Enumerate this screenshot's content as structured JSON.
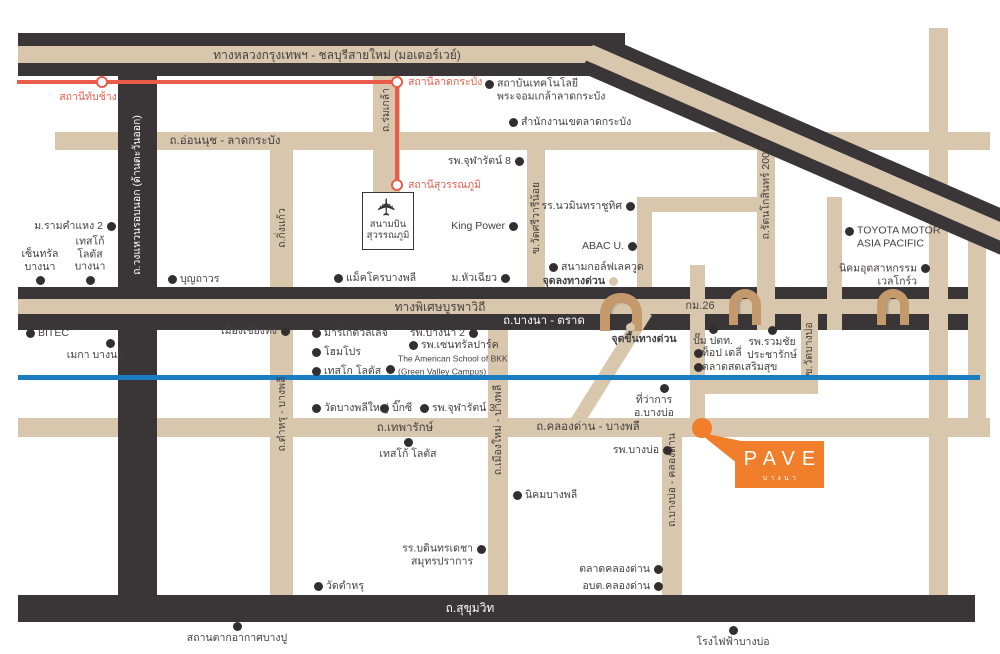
{
  "map": {
    "colors": {
      "tan": "#d9c7ad",
      "dark": "#3a3637",
      "text": "#454041",
      "red": "#e85c49",
      "blue": "#1a7dc1",
      "orange": "#f07e2a",
      "arch": "#c49a6c",
      "dot": "#332f30"
    },
    "tan_roads": [
      {
        "x": 55,
        "y": 132,
        "w": 935,
        "h": 18,
        "n": "onnut-ladkrabang-road"
      },
      {
        "x": 18,
        "y": 418,
        "w": 972,
        "h": 19,
        "n": "thepharak-klongdan-road"
      },
      {
        "x": 270,
        "y": 132,
        "w": 23,
        "h": 463,
        "n": "kingkaew-tamru-road"
      },
      {
        "x": 373,
        "y": 64,
        "w": 27,
        "h": 131,
        "n": "romklao-road"
      },
      {
        "x": 488,
        "y": 330,
        "w": 20,
        "h": 265,
        "n": "muangmai-bangphli-road"
      },
      {
        "x": 527,
        "y": 140,
        "w": 18,
        "h": 177,
        "n": "srivareenoi-road"
      },
      {
        "x": 662,
        "y": 420,
        "w": 20,
        "h": 175,
        "n": "bangbo-klongdan-road"
      },
      {
        "x": 637,
        "y": 197,
        "w": 138,
        "h": 15,
        "n": "link-road-horizontal"
      },
      {
        "x": 637,
        "y": 197,
        "w": 15,
        "h": 103,
        "n": "link-road-vertical"
      }
    ],
    "dark_roads": [
      {
        "x": 118,
        "y": 33,
        "w": 39,
        "h": 589,
        "n": "outer-ring-road"
      },
      {
        "x": 18,
        "y": 33,
        "w": 607,
        "h": 13,
        "n": "motorway-edge-top"
      },
      {
        "x": 18,
        "y": 46,
        "w": 607,
        "h": 17,
        "c": "#d9c7ad",
        "n": "motorway-center"
      },
      {
        "x": 18,
        "y": 63,
        "w": 607,
        "h": 13,
        "n": "motorway-edge-bottom"
      },
      {
        "x": 18,
        "y": 595,
        "w": 957,
        "h": 27,
        "n": "sukhumvit-road"
      }
    ],
    "band_roads": [
      {
        "x": 18,
        "y": 287,
        "w": 967,
        "h": 12,
        "c": "#3a3637",
        "n": "burapha-expressway-edge-top"
      },
      {
        "x": 18,
        "y": 299,
        "w": 967,
        "h": 15,
        "c": "#d9c7ad",
        "n": "burapha-expressway-center"
      },
      {
        "x": 18,
        "y": 314,
        "w": 967,
        "h": 16,
        "c": "#3a3637",
        "n": "bangna-trad-road"
      }
    ],
    "tan_roads_over": [
      {
        "x": 690,
        "y": 265,
        "w": 15,
        "h": 163,
        "n": "minor-road-a"
      },
      {
        "x": 757,
        "y": 132,
        "w": 18,
        "h": 198,
        "n": "rattanakosin-200pi-road"
      },
      {
        "x": 827,
        "y": 197,
        "w": 15,
        "h": 133,
        "n": "minor-road-b"
      },
      {
        "x": 801,
        "y": 300,
        "w": 17,
        "h": 94,
        "n": "watbangbo-road"
      },
      {
        "x": 700,
        "y": 380,
        "w": 118,
        "h": 14,
        "n": "watbangbo-road-elbow"
      },
      {
        "x": 929,
        "y": 28,
        "w": 19,
        "h": 567,
        "n": "right-vertical-road-1"
      },
      {
        "x": 968,
        "y": 222,
        "w": 18,
        "h": 206,
        "n": "right-vertical-road-2"
      }
    ],
    "diagonals": [
      {
        "kind": "band",
        "x": 598,
        "y": 33,
        "w": 472,
        "h": 43,
        "rot": 23.5,
        "stripes": [
          [
            "#3a3637",
            13
          ],
          [
            "#d9c7ad",
            17
          ],
          [
            "#3a3637",
            13
          ]
        ],
        "n": "motorway-diagonal"
      },
      {
        "kind": "plain",
        "x": 640,
        "y": 308,
        "w": 14,
        "h": 130,
        "rot": 32,
        "c": "#d9c7ad",
        "n": "expressway-ramp"
      }
    ],
    "blue_line": {
      "x": 18,
      "y": 375,
      "w": 962,
      "h": 5,
      "n": "blue-canal-line"
    },
    "arches": [
      {
        "x": 600,
        "y": 293,
        "w": 42,
        "h": 38,
        "b": 10
      },
      {
        "x": 729,
        "y": 289,
        "w": 32,
        "h": 36,
        "b": 9
      },
      {
        "x": 877,
        "y": 289,
        "w": 32,
        "h": 36,
        "b": 9
      }
    ],
    "rail": {
      "segments": [
        {
          "x": 17,
          "y": 80,
          "w": 382,
          "h": 4
        },
        {
          "x": 395,
          "y": 80,
          "w": 4,
          "h": 107
        }
      ],
      "stations": [
        {
          "cx": 102,
          "cy": 82,
          "label": "สถานีทับช้าง",
          "side": "below",
          "lx": 88,
          "ly": 97
        },
        {
          "cx": 397,
          "cy": 82,
          "label": "สถานีลาดกระบัง",
          "side": "right",
          "lx": 408,
          "ly": 82
        },
        {
          "cx": 397,
          "cy": 185,
          "label": "สถานีสุวรรณภูมิ",
          "side": "right",
          "lx": 408,
          "ly": 185
        }
      ]
    },
    "road_labels": [
      {
        "t": "ทางหลวงกรุงเทพฯ - ชลบุรีสายใหม่ (มอเตอร์เวย์)",
        "x": 337,
        "y": 55,
        "fs": 12
      },
      {
        "t": "ถ.อ่อนนุช - ลาดกระบัง",
        "x": 225,
        "y": 141,
        "fs": 11.5
      },
      {
        "t": "ทางพิเศษบูรพาวิถี",
        "x": 440,
        "y": 307,
        "fs": 12
      },
      {
        "t": "กม.26",
        "x": 700,
        "y": 306,
        "fs": 11
      },
      {
        "t": "ถ.บางนา - ตราด",
        "x": 544,
        "y": 321,
        "fs": 11.5,
        "c": "#ffffff"
      },
      {
        "t": "ถ.เทพารักษ์",
        "x": 405,
        "y": 428,
        "fs": 11.5
      },
      {
        "t": "ถ.คลองด่าน - บางพลี",
        "x": 588,
        "y": 427,
        "fs": 11.5
      },
      {
        "t": "ถ.สุขุมวิท",
        "x": 470,
        "y": 608,
        "fs": 12,
        "c": "#ffffff"
      },
      {
        "t": "ถ.วงแหวนรอบนอก (ด้านตะวันออก)",
        "x": 137,
        "y": 195,
        "rot": -90,
        "fs": 10.5,
        "c": "#ffffff"
      },
      {
        "t": "ถ.ร่มเกล้า",
        "x": 386,
        "y": 110,
        "rot": -90,
        "fs": 10.5
      },
      {
        "t": "ถ.กิ่งแก้ว",
        "x": 282,
        "y": 228,
        "rot": -90,
        "fs": 10.5
      },
      {
        "t": "ข.วัดศรีวารีน้อย",
        "x": 536,
        "y": 218,
        "rot": -90,
        "fs": 10.5
      },
      {
        "t": "ถ.รัตนโกสินทร์ 200 ปี",
        "x": 766,
        "y": 191,
        "rot": -90,
        "fs": 10.5
      },
      {
        "t": "ข.วัดบางบ่อ",
        "x": 809,
        "y": 349,
        "rot": -90,
        "fs": 10.5
      },
      {
        "t": "ถ.ตำหรุ - บางพลี",
        "x": 282,
        "y": 414,
        "rot": -90,
        "fs": 10.5
      },
      {
        "t": "ถ.เมืองใหม่ - บางพลี",
        "x": 498,
        "y": 430,
        "rot": -90,
        "fs": 10.5
      },
      {
        "t": "ถ.บางบ่อ - คลองด่าน",
        "x": 672,
        "y": 480,
        "rot": -90,
        "fs": 10.5
      }
    ],
    "pois": [
      {
        "d": [
          489,
          84
        ],
        "t": "สถาบันเทคโนโลยี\nพระจอมเกล้าลาดกระบัง",
        "side": "right",
        "dy": 6
      },
      {
        "d": [
          513,
          122
        ],
        "t": "สำนักงานเขตลาดกระบัง",
        "side": "right"
      },
      {
        "d": [
          519,
          161
        ],
        "t": "รพ.จุฬารัตน์ 8",
        "side": "left"
      },
      {
        "d": [
          513,
          226
        ],
        "t": "King Power",
        "side": "left"
      },
      {
        "d": [
          630,
          206
        ],
        "t": "รร.นวมินทราชูทิศ",
        "side": "left"
      },
      {
        "d": [
          632,
          246
        ],
        "t": "ABAC U.",
        "side": "left"
      },
      {
        "d": [
          553,
          267
        ],
        "t": "สนามกอล์ฟเลควูด",
        "side": "right"
      },
      {
        "d": [
          613,
          281
        ],
        "t": "จุดลงทางด่วน",
        "side": "left",
        "b": true,
        "tan": true
      },
      {
        "d": [
          338,
          278
        ],
        "t": "แม็คโครบางพลี",
        "side": "right"
      },
      {
        "d": [
          505,
          278
        ],
        "t": "ม.หัวเฉียว",
        "side": "left"
      },
      {
        "d": [
          849,
          231
        ],
        "t": "TOYOTA MOTOR\nASIA PACIFIC",
        "side": "right",
        "dy": 6
      },
      {
        "d": [
          925,
          268
        ],
        "t": "นิคมอุตสาหกรรม\nเวลโกร์ว",
        "side": "left",
        "dy": 7
      },
      {
        "d": [
          111,
          226
        ],
        "t": "ม.รามคำแหง 2",
        "side": "left"
      },
      {
        "d": [
          40,
          280
        ],
        "t": "เซ็นทรัล\nบางนา",
        "side": "above"
      },
      {
        "d": [
          90,
          280
        ],
        "t": "เทสโก้\nโลตัส\nบางนา",
        "side": "above"
      },
      {
        "d": [
          172,
          279
        ],
        "t": "บุญถาวร",
        "side": "right"
      },
      {
        "d": [
          30,
          333
        ],
        "t": "BITEC",
        "side": "right"
      },
      {
        "d": [
          110,
          343
        ],
        "t": "เมกา บางนา",
        "side": "below",
        "dx": -15
      },
      {
        "d": [
          285,
          331
        ],
        "t": "เมืองเชียงทง",
        "side": "left"
      },
      {
        "d": [
          316,
          333
        ],
        "t": "มาร์เกตวิลเลจ",
        "side": "right"
      },
      {
        "d": [
          316,
          352
        ],
        "t": "โฮมโปร",
        "side": "right"
      },
      {
        "d": [
          316,
          371
        ],
        "t": "เทสโก โลตัส",
        "side": "right"
      },
      {
        "d": [
          473,
          333
        ],
        "t": "รพ.บางนา 2",
        "side": "left"
      },
      {
        "d": [
          413,
          345
        ],
        "t": "รพ.เซนทรัลปาร์ค",
        "side": "right"
      },
      {
        "d": [
          390,
          369
        ],
        "t": "The American School of BKK\n(Green Valley Campus)",
        "side": "right",
        "fs": 8.5,
        "dy": -4
      },
      {
        "d": [
          316,
          408
        ],
        "t": "วัดบางพลีใหญ่",
        "side": "right"
      },
      {
        "d": [
          384,
          408
        ],
        "t": "บิ๊กซี",
        "side": "right"
      },
      {
        "d": [
          424,
          408
        ],
        "t": "รพ.จุฬารัตน์ 3",
        "side": "right"
      },
      {
        "d": [
          713,
          329
        ],
        "t": "ปั๊ม ปตท.",
        "side": "below"
      },
      {
        "d": [
          772,
          330
        ],
        "t": "รพ.รวมชัย\nประชารักษ์",
        "side": "below"
      },
      {
        "d": [
          698,
          353
        ],
        "t": "ท็อป เดลี่",
        "side": "right",
        "gap": 4
      },
      {
        "d": [
          698,
          367
        ],
        "t": "ตลาดสดเสริมสุข",
        "side": "right",
        "gap": 4
      },
      {
        "d": [
          630,
          327
        ],
        "t": "จุดขึ้นทางด่วน",
        "side": "below",
        "dx": 14,
        "b": true,
        "tan": true
      },
      {
        "d": [
          664,
          388
        ],
        "t": "ที่ว่าการ\nอ.บางบ่อ",
        "side": "below",
        "dx": -10
      },
      {
        "d": [
          667,
          450
        ],
        "t": "รพ.บางบ่อ",
        "side": "left"
      },
      {
        "d": [
          517,
          495
        ],
        "t": "นิคมบางพลี",
        "side": "right"
      },
      {
        "d": [
          408,
          442
        ],
        "t": "เทสโก้ โลตัส",
        "side": "below"
      },
      {
        "d": [
          481,
          549
        ],
        "t": "รร.บดินทรเดชา\nสมุทรปราการ",
        "side": "left",
        "dy": 6
      },
      {
        "d": [
          318,
          586
        ],
        "t": "วัดตำหรุ",
        "side": "right"
      },
      {
        "d": [
          658,
          569
        ],
        "t": "ตลาดคลองด่าน",
        "side": "left"
      },
      {
        "d": [
          658,
          586
        ],
        "t": "อบต.คลองด่าน",
        "side": "left"
      },
      {
        "d": [
          733,
          630
        ],
        "t": "โรงไฟฟ้าบางบ่อ",
        "side": "below"
      },
      {
        "d": [
          237,
          626
        ],
        "t": "สถานตากอากาศบางปู",
        "side": "below"
      }
    ],
    "airport": {
      "name": "สนามบิน\nสุวรรณภูมิ",
      "icon": "airplane-icon",
      "glyph": "✈"
    },
    "pave": {
      "word": "PAVE",
      "sub": "บางนา"
    }
  }
}
